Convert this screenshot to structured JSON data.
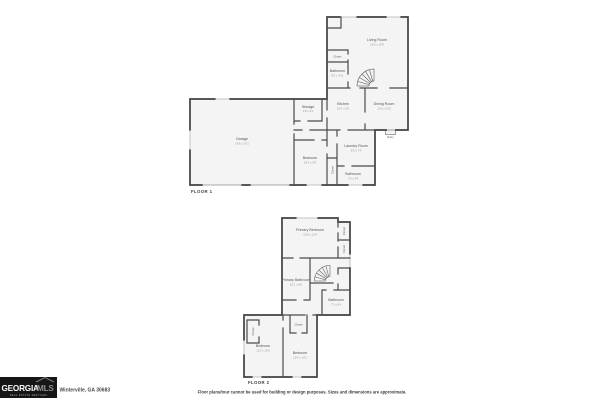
{
  "branding": {
    "logo_primary": "GEORGIA",
    "logo_secondary": "MLS",
    "logo_tagline": "REAL ESTATE SERVICES",
    "logo_icon": "house-roof-icon",
    "address": "Winterville, GA 30683"
  },
  "footer": {
    "disclaimer": "Floor plans/tour cannot be used for building or design purposes. Sizes and dimensions are approximate."
  },
  "colors": {
    "background": "#ffffff",
    "wall": "#414141",
    "room_fill": "#f4f4f4",
    "label": "#555555",
    "dims": "#9a9a9a",
    "logo_bg": "#161616"
  },
  "floor1": {
    "title": "FLOOR 1",
    "rooms": {
      "living_room": {
        "name": "Living Room",
        "dims": "16'5 x 15'9"
      },
      "closet_upper": {
        "name": "Closet",
        "dims": ""
      },
      "bathroom_upper": {
        "name": "Bathroom",
        "dims": "8'2 x 4'11"
      },
      "storage": {
        "name": "Storage",
        "dims": "4'8 x 3'2"
      },
      "kitchen": {
        "name": "Kitchen",
        "dims": "10'0 x 9'2"
      },
      "dining_room": {
        "name": "Dining Room",
        "dims": "11'6 x 9'10"
      },
      "garage": {
        "name": "Garage",
        "dims": "19'5 x 20'1"
      },
      "bedroom": {
        "name": "Bedroom",
        "dims": "10'4 x 9'8"
      },
      "laundry_room": {
        "name": "Laundry Room",
        "dims": "8'6 x 7'4"
      },
      "bathroom_lower": {
        "name": "Bathroom",
        "dims": "7'6 x 4'8"
      },
      "closet_lower": {
        "name": "Closet",
        "dims": ""
      },
      "entry": {
        "name": "Entry",
        "dims": ""
      }
    }
  },
  "floor2": {
    "title": "FLOOR 2",
    "rooms": {
      "primary_bedroom": {
        "name": "Primary Bedroom",
        "dims": "15'8 x 12'4"
      },
      "closet_right_1": {
        "name": "Closet",
        "dims": ""
      },
      "closet_right_2": {
        "name": "Closet",
        "dims": ""
      },
      "primary_bathroom": {
        "name": "Primary Bathroom",
        "dims": "10'2 x 8'6"
      },
      "bathroom": {
        "name": "Bathroom",
        "dims": "7'2 x 6'4"
      },
      "closet_hall": {
        "name": "Closet",
        "dims": ""
      },
      "closet_left": {
        "name": "Closet",
        "dims": ""
      },
      "bedroom_left": {
        "name": "Bedroom",
        "dims": "11'3 x 10'6"
      },
      "bedroom_right": {
        "name": "Bedroom",
        "dims": "12'4 x 10'2"
      }
    }
  }
}
